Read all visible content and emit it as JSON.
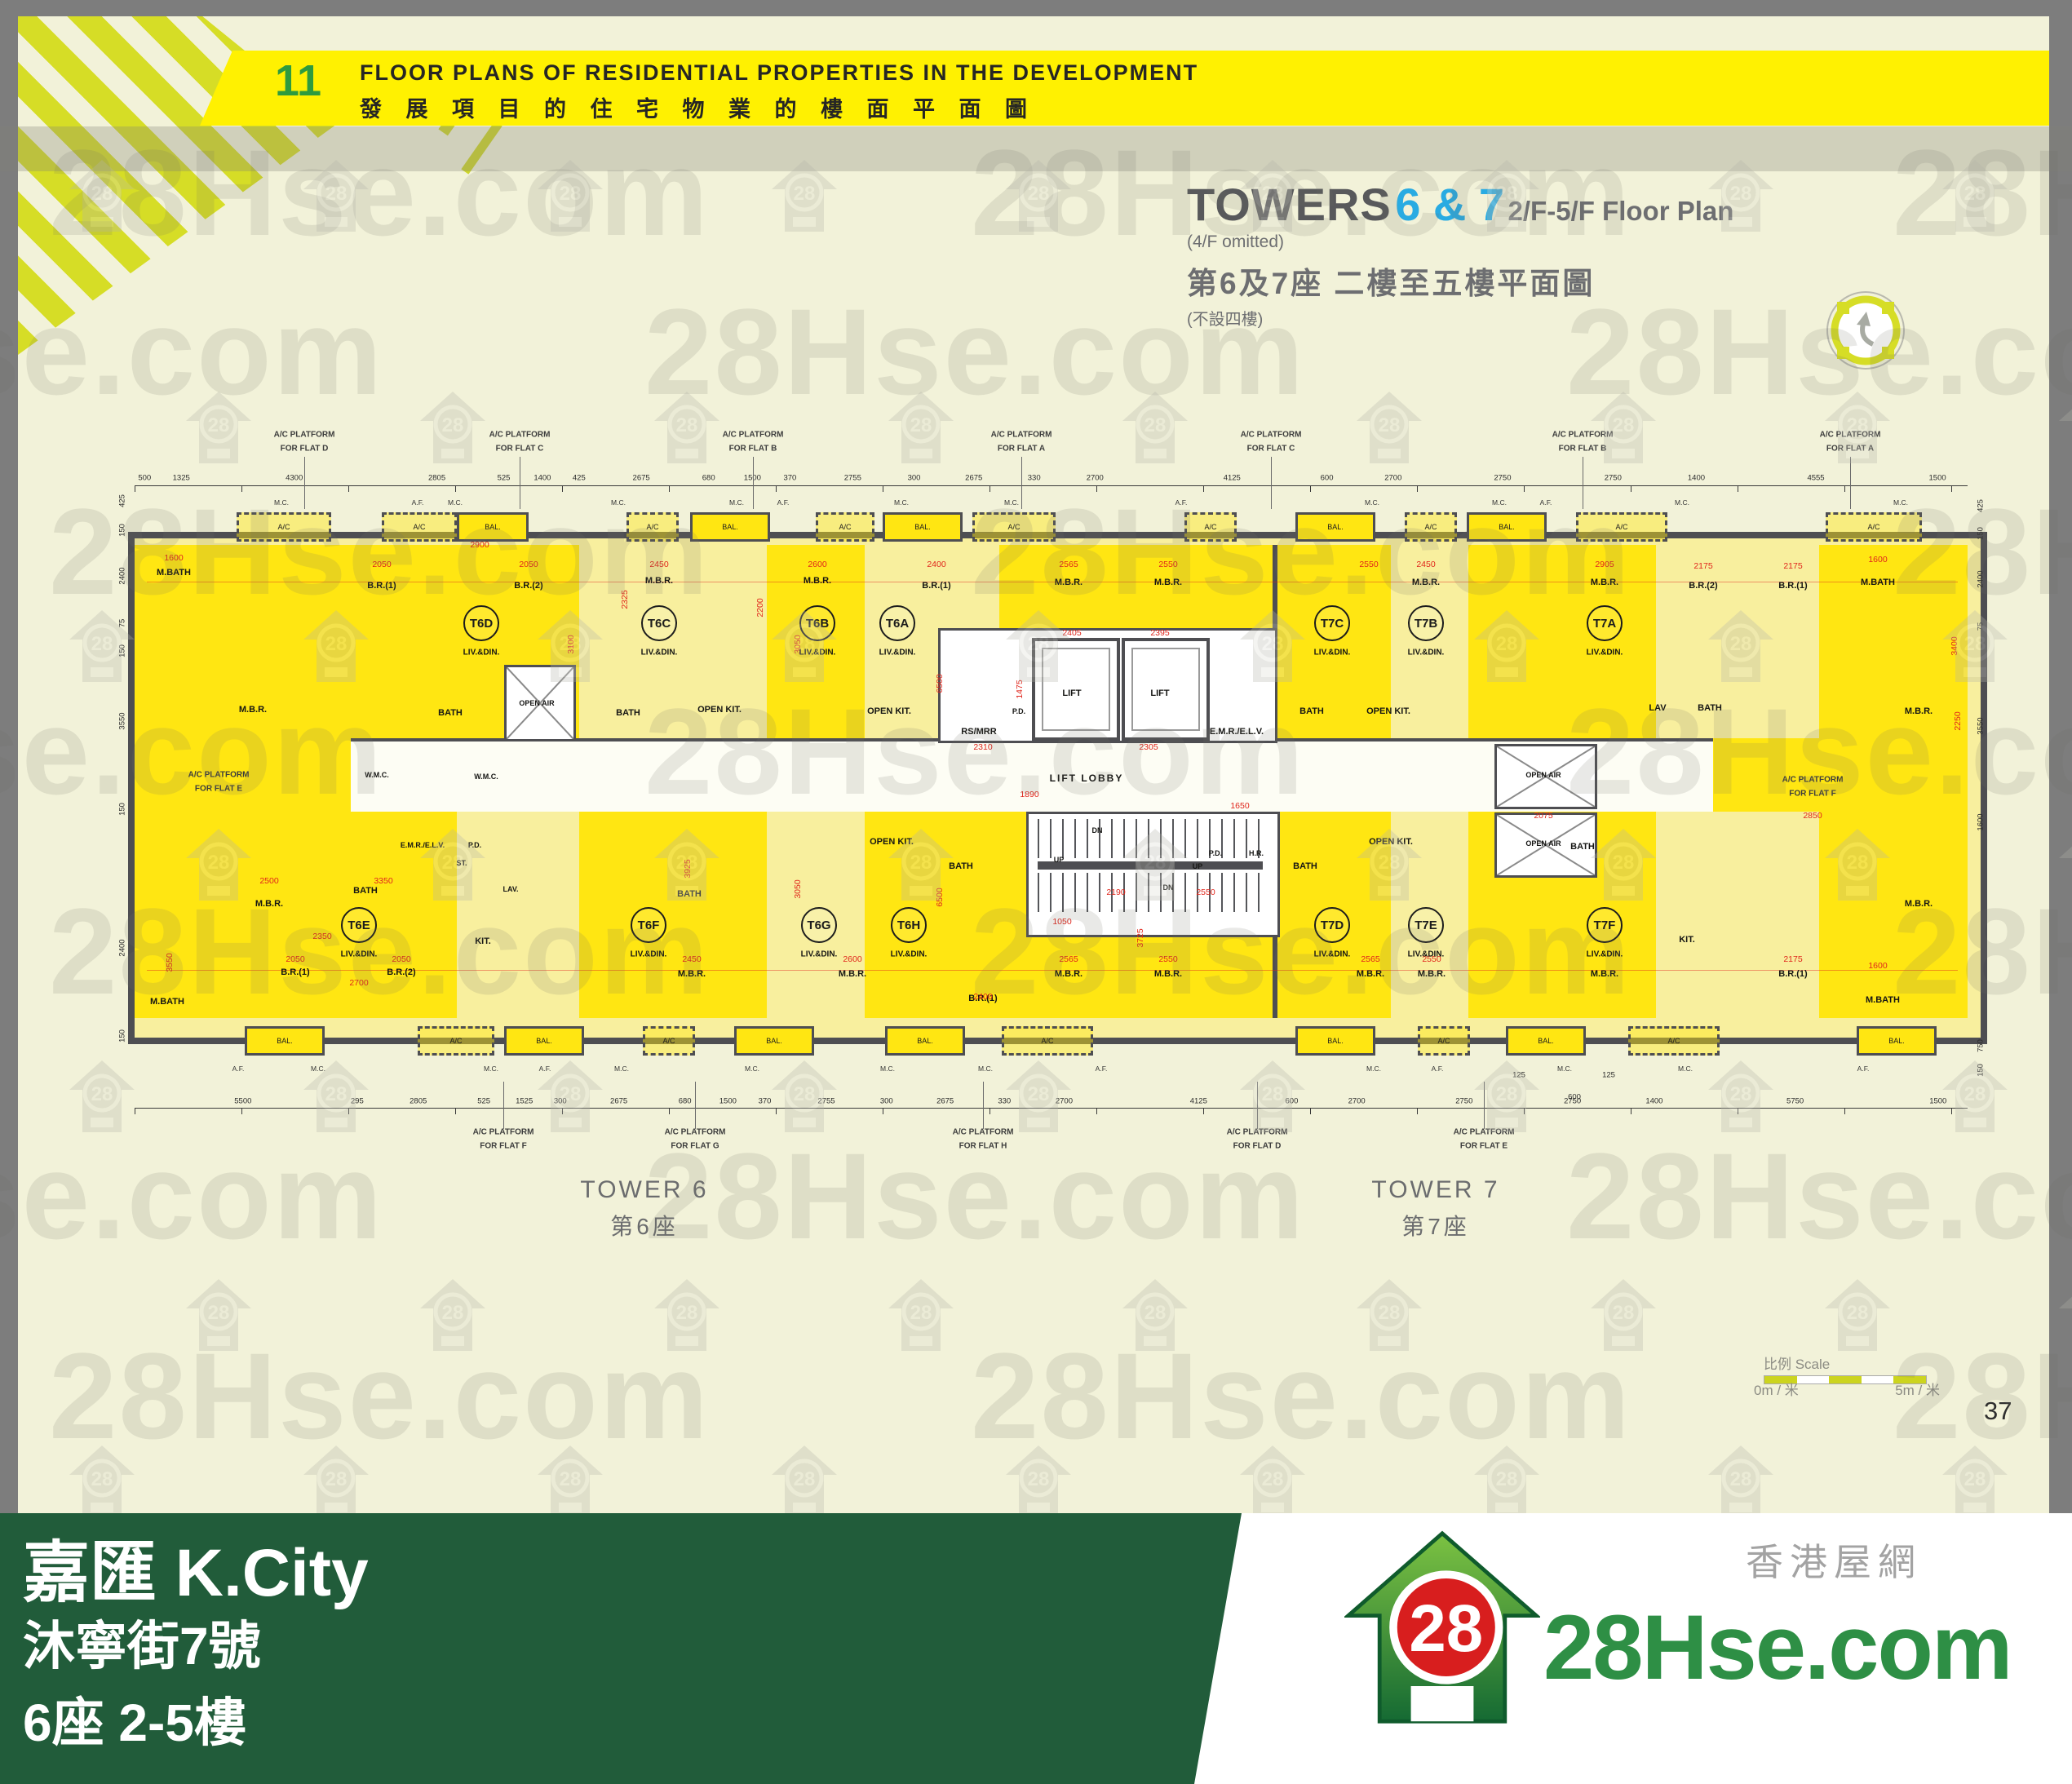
{
  "header": {
    "page_index": "11",
    "title_en": "FLOOR PLANS OF RESIDENTIAL PROPERTIES IN THE DEVELOPMENT",
    "title_zh": "發 展 項 目 的 住 宅 物 業 的 樓 面 平 面 圖"
  },
  "title_block": {
    "towers": "TOWERS",
    "tower_numbers": "6 & 7",
    "floors": "2/F-5/F Floor Plan",
    "omitted": "(4/F omitted)",
    "zh": "第6及7座 二樓至五樓平面圖",
    "zh_note": "(不設四樓)"
  },
  "plan": {
    "acp_label": "A/C PLATFORM",
    "acp_for": "FOR FLAT",
    "acp_top": [
      [
        373,
        "D"
      ],
      [
        637,
        "C"
      ],
      [
        923,
        "B"
      ],
      [
        1252,
        "A"
      ],
      [
        1558,
        "C"
      ],
      [
        1940,
        "B"
      ],
      [
        2268,
        "A"
      ]
    ],
    "acp_bottom": [
      [
        617,
        "F"
      ],
      [
        852,
        "G"
      ],
      [
        1205,
        "H"
      ],
      [
        1541,
        "D"
      ],
      [
        1819,
        "E"
      ]
    ],
    "acp_side": [
      [
        268,
        950,
        "E"
      ],
      [
        2222,
        956,
        "F"
      ]
    ],
    "top_dims": [
      "500",
      "1325",
      "4300",
      "2805",
      "525",
      "1400",
      "425",
      "2675",
      "680",
      "1500",
      "370",
      "2755",
      "300",
      "2675",
      "330",
      "2700",
      "4125",
      "600",
      "2700",
      "2750",
      "2750",
      "1400",
      "4555",
      "1500"
    ],
    "bottom_dims": [
      "5500",
      "295",
      "2805",
      "525",
      "1525",
      "300",
      "2675",
      "680",
      "1500",
      "370",
      "2755",
      "300",
      "2675",
      "330",
      "2700",
      "4125",
      "600",
      "2700",
      "2750",
      "2750",
      "1400",
      "5750",
      "1500"
    ],
    "left_dims": [
      [
        "425",
        614
      ],
      [
        "150",
        650
      ],
      [
        "2400",
        706
      ],
      [
        "75",
        764
      ],
      [
        "150",
        798
      ],
      [
        "3550",
        884
      ],
      [
        "150",
        992
      ],
      [
        "2400",
        1162
      ],
      [
        "150",
        1270
      ]
    ],
    "right_dims": [
      [
        "425",
        620
      ],
      [
        "150",
        654
      ],
      [
        "2400",
        710
      ],
      [
        "75",
        768
      ],
      [
        "3550",
        890
      ],
      [
        "1600",
        1008
      ],
      [
        "750",
        1282
      ],
      [
        "150",
        1312
      ]
    ],
    "units_sub": "LIV.&DIN.",
    "units": [
      [
        "T6D",
        590,
        764
      ],
      [
        "T6C",
        808,
        764
      ],
      [
        "T6B",
        1002,
        764
      ],
      [
        "T6A",
        1100,
        764
      ],
      [
        "T7C",
        1633,
        764
      ],
      [
        "T7B",
        1748,
        764
      ],
      [
        "T7A",
        1967,
        764
      ],
      [
        "T6E",
        440,
        1134
      ],
      [
        "T6F",
        795,
        1134
      ],
      [
        "T6G",
        1004,
        1134
      ],
      [
        "T6H",
        1114,
        1134
      ],
      [
        "T7D",
        1633,
        1134
      ],
      [
        "T7E",
        1748,
        1134
      ],
      [
        "T7F",
        1967,
        1134
      ]
    ],
    "top_boxes": [
      [
        290,
        110,
        "A/C",
        1
      ],
      [
        468,
        86,
        "A/C",
        1
      ],
      [
        560,
        82,
        "BAL.",
        0
      ],
      [
        768,
        58,
        "A/C",
        1
      ],
      [
        846,
        92,
        "BAL.",
        0
      ],
      [
        1000,
        66,
        "A/C",
        1
      ],
      [
        1082,
        92,
        "BAL.",
        0
      ],
      [
        1192,
        96,
        "A/C",
        1
      ],
      [
        1452,
        58,
        "A/C",
        1
      ],
      [
        1588,
        92,
        "BAL.",
        0
      ],
      [
        1722,
        58,
        "A/C",
        1
      ],
      [
        1798,
        92,
        "BAL.",
        0
      ],
      [
        1932,
        106,
        "A/C",
        1
      ],
      [
        2238,
        112,
        "A/C",
        1
      ]
    ],
    "bottom_boxes": [
      [
        300,
        92,
        "BAL.",
        0
      ],
      [
        512,
        88,
        "A/C",
        1
      ],
      [
        618,
        92,
        "BAL.",
        0
      ],
      [
        788,
        58,
        "A/C",
        1
      ],
      [
        900,
        92,
        "BAL.",
        0
      ],
      [
        1085,
        92,
        "BAL.",
        0
      ],
      [
        1228,
        106,
        "A/C",
        1
      ],
      [
        1588,
        92,
        "BAL.",
        0
      ],
      [
        1738,
        58,
        "A/C",
        1
      ],
      [
        1846,
        92,
        "BAL.",
        0
      ],
      [
        1996,
        106,
        "A/C",
        1
      ],
      [
        2276,
        92,
        "BAL.",
        0
      ]
    ],
    "ann": [
      [
        "M.BATH",
        213,
        702,
        "r"
      ],
      [
        "B.R.(1)",
        468,
        718,
        "r"
      ],
      [
        "B.R.(2)",
        648,
        718,
        "r"
      ],
      [
        "M.B.R.",
        310,
        870,
        "r"
      ],
      [
        "BATH",
        552,
        874,
        "r"
      ],
      [
        "M.B.R.",
        808,
        712,
        "r"
      ],
      [
        "BATH",
        770,
        874,
        "r"
      ],
      [
        "OPEN KIT.",
        882,
        870,
        "r"
      ],
      [
        "M.B.R.",
        1002,
        712,
        "r"
      ],
      [
        "B.R.(1)",
        1148,
        718,
        "r"
      ],
      [
        "OPEN KIT.",
        1090,
        872,
        "r"
      ],
      [
        "M.B.R.",
        1310,
        714,
        "r"
      ],
      [
        "M.B.R.",
        1432,
        714,
        "r"
      ],
      [
        "BATH",
        1608,
        872,
        "r"
      ],
      [
        "OPEN KIT.",
        1702,
        872,
        "r"
      ],
      [
        "M.B.R.",
        1748,
        714,
        "r"
      ],
      [
        "M.B.R.",
        1967,
        714,
        "r"
      ],
      [
        "B.R.(2)",
        2088,
        718,
        "r"
      ],
      [
        "B.R.(1)",
        2198,
        718,
        "r"
      ],
      [
        "M.BATH",
        2302,
        714,
        "r"
      ],
      [
        "BATH",
        2096,
        868,
        "r"
      ],
      [
        "LAV",
        2032,
        868,
        "r"
      ],
      [
        "M.B.R.",
        2352,
        872,
        "r"
      ],
      [
        "LIFT",
        1314,
        850,
        "r"
      ],
      [
        "LIFT",
        1422,
        850,
        "r"
      ],
      [
        "RS/MRR",
        1200,
        897,
        "r"
      ],
      [
        "E.M.R./E.L.V.",
        1516,
        897,
        "r"
      ],
      [
        "LIFT LOBBY",
        1332,
        954,
        "L"
      ],
      [
        "M.B.R.",
        330,
        1108,
        "r"
      ],
      [
        "BATH",
        448,
        1092,
        "r"
      ],
      [
        "KIT.",
        592,
        1154,
        "r"
      ],
      [
        "M.BATH",
        205,
        1228,
        "r"
      ],
      [
        "B.R.(1)",
        362,
        1192,
        "r"
      ],
      [
        "B.R.(2)",
        492,
        1192,
        "r"
      ],
      [
        "BATH",
        845,
        1096,
        "r"
      ],
      [
        "M.B.R.",
        848,
        1194,
        "r"
      ],
      [
        "M.B.R.",
        1045,
        1194,
        "r"
      ],
      [
        "OPEN KIT.",
        1093,
        1032,
        "r"
      ],
      [
        "BATH",
        1178,
        1062,
        "r"
      ],
      [
        "B.R.(1)",
        1205,
        1224,
        "r"
      ],
      [
        "M.B.R.",
        1310,
        1194,
        "r"
      ],
      [
        "M.B.R.",
        1432,
        1194,
        "r"
      ],
      [
        "BATH",
        1600,
        1062,
        "r"
      ],
      [
        "M.B.R.",
        1680,
        1194,
        "r"
      ],
      [
        "OPEN KIT.",
        1705,
        1032,
        "r"
      ],
      [
        "M.B.R.",
        1755,
        1194,
        "r"
      ],
      [
        "BATH",
        1940,
        1038,
        "r"
      ],
      [
        "M.B.R.",
        1967,
        1194,
        "r"
      ],
      [
        "KIT.",
        2068,
        1152,
        "r"
      ],
      [
        "B.R.(1)",
        2198,
        1194,
        "r"
      ],
      [
        "M.BATH",
        2308,
        1226,
        "r"
      ],
      [
        "M.B.R.",
        2352,
        1108,
        "r"
      ],
      [
        "P.D.",
        1249,
        872,
        "s"
      ],
      [
        "P.D.",
        1490,
        1046,
        "s"
      ],
      [
        "H.R.",
        1540,
        1046,
        "s"
      ],
      [
        "OPEN AIR",
        658,
        862,
        "s"
      ],
      [
        "W.M.C.",
        596,
        952,
        "s"
      ],
      [
        "E.M.R./E.L.V.",
        518,
        1036,
        "s"
      ],
      [
        "P.D.",
        582,
        1036,
        "s"
      ],
      [
        "OPEN AIR",
        1892,
        950,
        "s"
      ],
      [
        "OPEN AIR",
        1892,
        1034,
        "s"
      ],
      [
        "DN",
        1345,
        1018,
        "s"
      ],
      [
        "UP",
        1298,
        1054,
        "s"
      ],
      [
        "UP",
        1468,
        1062,
        "s"
      ],
      [
        "DN",
        1432,
        1088,
        "s"
      ],
      [
        "ST.",
        566,
        1058,
        "s"
      ],
      [
        "LAV.",
        626,
        1090,
        "s"
      ],
      [
        "W.M.C.",
        462,
        950,
        "s"
      ],
      [
        "1600",
        213,
        684,
        "d"
      ],
      [
        "2050",
        468,
        692,
        "d"
      ],
      [
        "2050",
        648,
        692,
        "d"
      ],
      [
        "2900",
        588,
        668,
        "d"
      ],
      [
        "2450",
        808,
        692,
        "d"
      ],
      [
        "2600",
        1002,
        692,
        "d"
      ],
      [
        "2400",
        1148,
        692,
        "d"
      ],
      [
        "2565",
        1310,
        692,
        "d"
      ],
      [
        "2550",
        1432,
        692,
        "d"
      ],
      [
        "2550",
        1678,
        692,
        "d"
      ],
      [
        "2450",
        1748,
        692,
        "d"
      ],
      [
        "2905",
        1967,
        692,
        "d"
      ],
      [
        "2175",
        2088,
        694,
        "d"
      ],
      [
        "2175",
        2198,
        694,
        "d"
      ],
      [
        "1600",
        2302,
        686,
        "d"
      ],
      [
        "2310",
        1205,
        916,
        "d"
      ],
      [
        "2305",
        1408,
        916,
        "d"
      ],
      [
        "1890",
        1262,
        974,
        "d"
      ],
      [
        "1650",
        1520,
        988,
        "d"
      ],
      [
        "2190",
        1368,
        1094,
        "d"
      ],
      [
        "2550",
        1478,
        1094,
        "d"
      ],
      [
        "1050",
        1302,
        1130,
        "d"
      ],
      [
        "2075",
        1892,
        1000,
        "d"
      ],
      [
        "2850",
        2222,
        1000,
        "d"
      ],
      [
        "2500",
        330,
        1080,
        "d"
      ],
      [
        "3350",
        470,
        1080,
        "d"
      ],
      [
        "2350",
        395,
        1148,
        "d"
      ],
      [
        "2050",
        362,
        1176,
        "d"
      ],
      [
        "2050",
        492,
        1176,
        "d"
      ],
      [
        "2700",
        440,
        1205,
        "d"
      ],
      [
        "2450",
        848,
        1176,
        "d"
      ],
      [
        "2600",
        1045,
        1176,
        "d"
      ],
      [
        "2400",
        1205,
        1222,
        "d"
      ],
      [
        "2565",
        1310,
        1176,
        "d"
      ],
      [
        "2550",
        1432,
        1176,
        "d"
      ],
      [
        "2565",
        1680,
        1176,
        "d"
      ],
      [
        "2550",
        1755,
        1176,
        "d"
      ],
      [
        "2175",
        2198,
        1176,
        "d"
      ],
      [
        "1600",
        2302,
        1184,
        "d"
      ],
      [
        "2405",
        1314,
        776,
        "d"
      ],
      [
        "2395",
        1422,
        776,
        "d"
      ],
      [
        "3100",
        700,
        790,
        "v"
      ],
      [
        "2200",
        932,
        745,
        "v"
      ],
      [
        "3050",
        978,
        790,
        "v"
      ],
      [
        "6500",
        1152,
        838,
        "v"
      ],
      [
        "2325",
        766,
        735,
        "v"
      ],
      [
        "3400",
        2396,
        792,
        "v"
      ],
      [
        "2250",
        2400,
        884,
        "v"
      ],
      [
        "3925",
        843,
        1065,
        "v"
      ],
      [
        "6500",
        1152,
        1100,
        "v"
      ],
      [
        "3725",
        1398,
        1150,
        "v"
      ],
      [
        "1475",
        1250,
        845,
        "v"
      ],
      [
        "3550",
        208,
        1180,
        "v"
      ],
      [
        "3050",
        978,
        1090,
        "v"
      ],
      [
        "600",
        1930,
        1345,
        "b"
      ],
      [
        "125",
        1862,
        1318,
        "b"
      ],
      [
        "125",
        1972,
        1318,
        "b"
      ],
      [
        "M.C.",
        345,
        616,
        "m"
      ],
      [
        "A.F.",
        512,
        616,
        "m"
      ],
      [
        "M.C.",
        558,
        616,
        "m"
      ],
      [
        "M.C.",
        758,
        616,
        "m"
      ],
      [
        "M.C.",
        903,
        616,
        "m"
      ],
      [
        "A.F.",
        960,
        616,
        "m"
      ],
      [
        "M.C.",
        1105,
        616,
        "m"
      ],
      [
        "M.C.",
        1240,
        616,
        "m"
      ],
      [
        "A.F.",
        1448,
        616,
        "m"
      ],
      [
        "M.C.",
        1682,
        616,
        "m"
      ],
      [
        "M.C.",
        1838,
        616,
        "m"
      ],
      [
        "A.F.",
        1895,
        616,
        "m"
      ],
      [
        "M.C.",
        2062,
        616,
        "m"
      ],
      [
        "M.C.",
        2330,
        616,
        "m"
      ],
      [
        "A.F.",
        292,
        1310,
        "m"
      ],
      [
        "M.C.",
        390,
        1310,
        "m"
      ],
      [
        "M.C.",
        602,
        1310,
        "m"
      ],
      [
        "A.F.",
        668,
        1310,
        "m"
      ],
      [
        "M.C.",
        762,
        1310,
        "m"
      ],
      [
        "M.C.",
        922,
        1310,
        "m"
      ],
      [
        "M.C.",
        1088,
        1310,
        "m"
      ],
      [
        "M.C.",
        1208,
        1310,
        "m"
      ],
      [
        "A.F.",
        1350,
        1310,
        "m"
      ],
      [
        "M.C.",
        1684,
        1310,
        "m"
      ],
      [
        "A.F.",
        1762,
        1310,
        "m"
      ],
      [
        "M.C.",
        1918,
        1310,
        "m"
      ],
      [
        "M.C.",
        2066,
        1310,
        "m"
      ],
      [
        "A.F.",
        2284,
        1310,
        "m"
      ]
    ],
    "tower6_en": "TOWER 6",
    "tower6_zh": "第6座",
    "tower7_en": "TOWER 7",
    "tower7_zh": "第7座"
  },
  "scalebar": {
    "label": "比例 Scale",
    "left": "0m / 米",
    "right": "5m / 米"
  },
  "page_number": "37",
  "footer": {
    "project": "嘉匯 K.City",
    "address": "沐寧街7號",
    "floors": "6座 2-5樓",
    "brand": "28Hse.com",
    "brand_zh": "香港屋網",
    "logo_28": "28"
  },
  "watermark": {
    "text": "28Hse.com",
    "badge": "28"
  },
  "colors": {
    "banner_yellow": "#fff101",
    "stripe": "#d6dd26",
    "index_green": "#2e9b3e",
    "tower_blue": "#29abe2",
    "unit_bright": "#ffe612",
    "unit_pale": "#f8ef9e",
    "wall": "#4e4e52",
    "dim_red": "#e0261c",
    "footer_green": "#215c3a",
    "logo_green": "#2e8f45",
    "page_cream": "#f2f2d9"
  }
}
